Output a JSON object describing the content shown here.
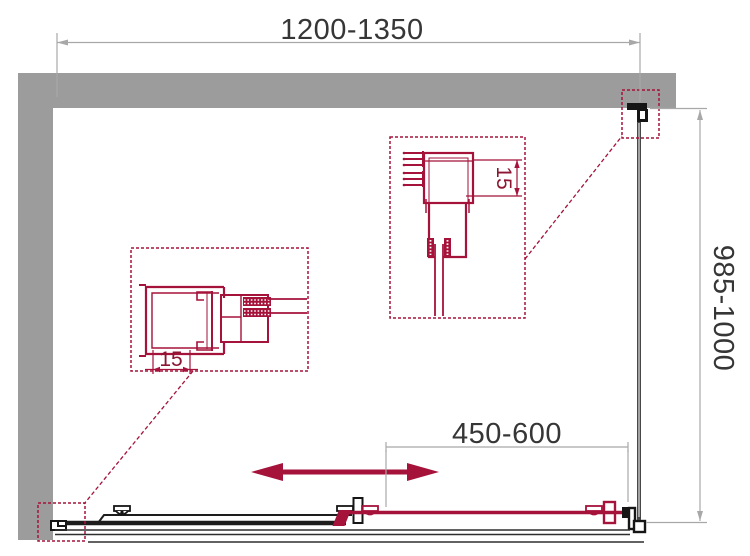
{
  "diagram": {
    "type": "technical-drawing",
    "subject": "shower-enclosure-top-view-plan",
    "labels": {
      "width_range": "1200-1350",
      "depth_range": "985-1000",
      "door_opening_range": "450-600",
      "profile_adjustment_a": "15",
      "profile_adjustment_b": "15"
    },
    "colors": {
      "accent_red": "#A5123A",
      "dark_red_text": "#8C1531",
      "wall_gray": "#9C9C9C",
      "line_dark": "#1D1D1D",
      "ink_black": "#161616",
      "glass_gray": "#474747",
      "dim_gray": "#A8A8A8",
      "text_dark": "#363636",
      "bg": "#FFFFFF"
    }
  }
}
